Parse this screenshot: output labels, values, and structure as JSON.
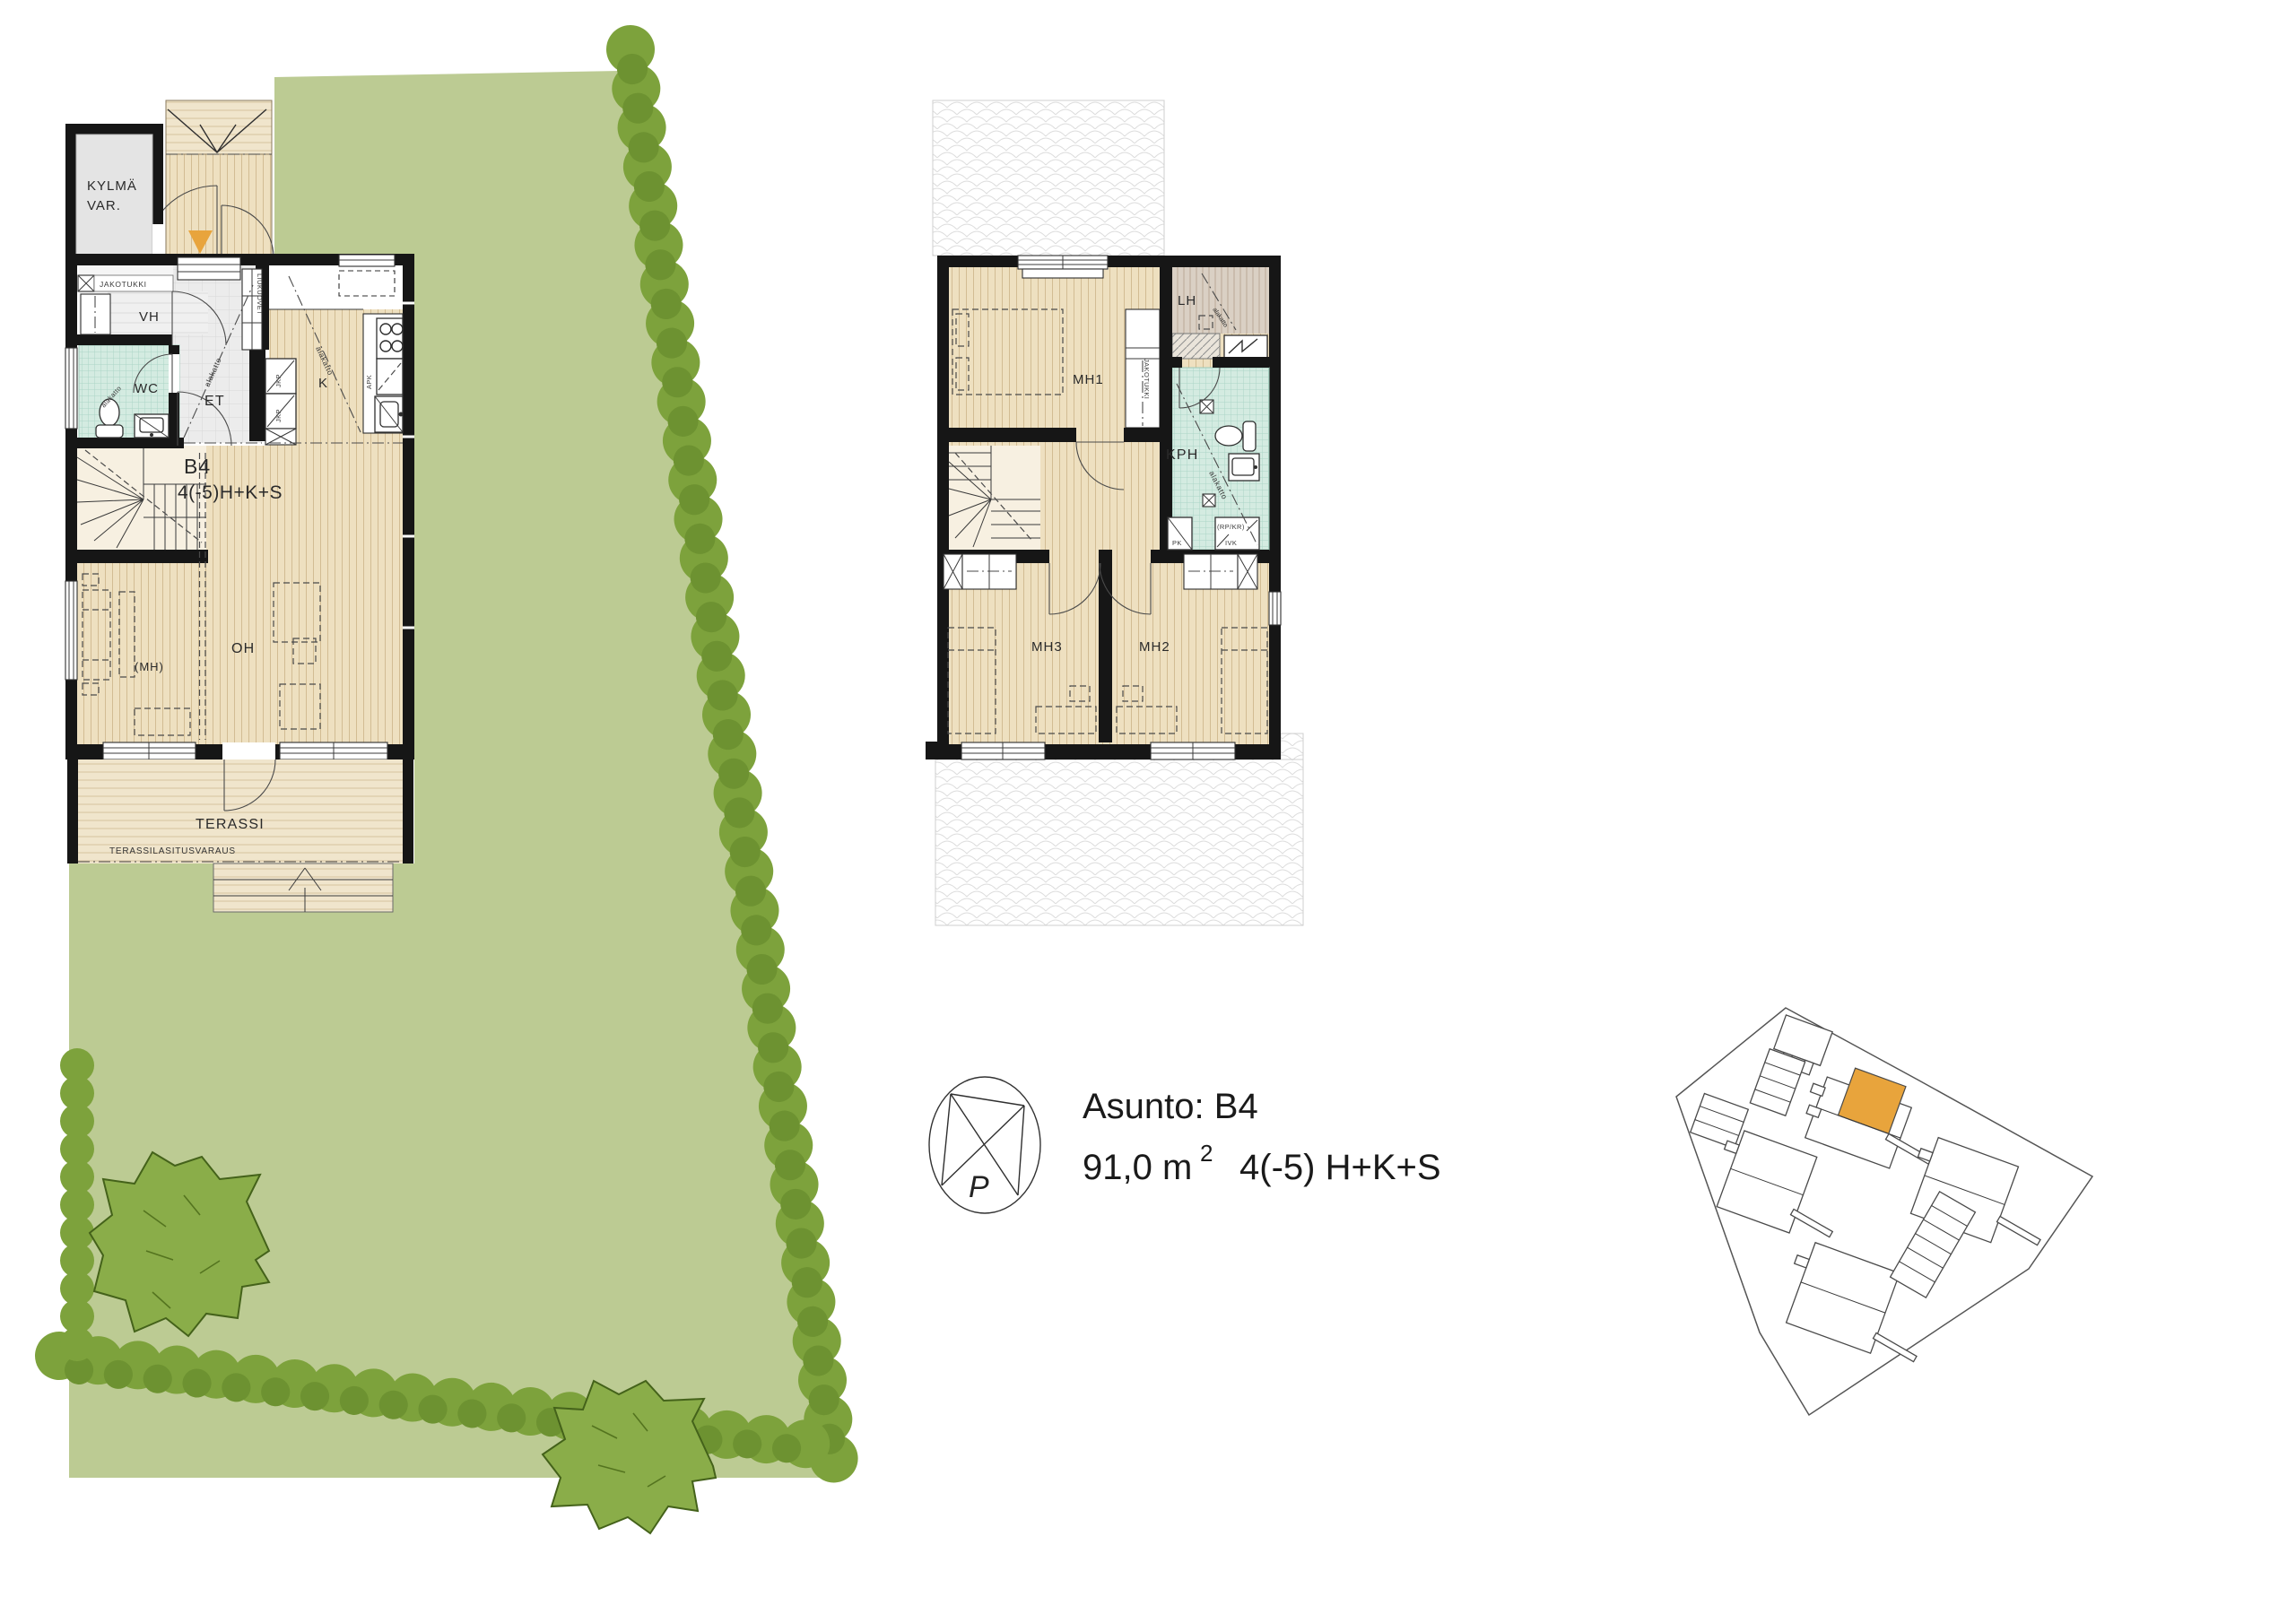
{
  "info": {
    "unit_label": "Asunto: B4",
    "area": "91,0 m",
    "area_superscript": "2",
    "room_spec": "4(-5) H+K+S",
    "compass_north": "P"
  },
  "ground_floor": {
    "unit_id": "B4",
    "unit_spec": "4(-5)H+K+S",
    "room_labels": {
      "cold_storage_1": "KYLMÄ",
      "cold_storage_2": "VAR.",
      "vestibule": "VH",
      "wc": "WC",
      "entry": "ET",
      "kitchen": "K",
      "living_room": "OH",
      "optional_bedroom": "(MH)",
      "terrace": "TERASSI"
    },
    "small_labels": {
      "manifold": "JAKOTUKKI",
      "sliding_doors": "LIUKUOVET",
      "suspended_ceiling": "alakatto",
      "fridge": "JKP",
      "dishwasher": "APK",
      "terrace_glazing": "TERASSILASITUSVARAUS"
    }
  },
  "upper_floor": {
    "room_labels": {
      "bedroom1": "MH1",
      "bedroom2": "MH2",
      "bedroom3": "MH3",
      "bathroom": "KPH",
      "sauna": "LH"
    },
    "small_labels": {
      "manifold": "JAKOTUKKI",
      "suspended_ceiling": "alakatto",
      "washing_machine": "PK",
      "rp_kr": "(RP/KR)",
      "ivk": "IVK"
    }
  },
  "colors": {
    "yard_green": "#bccb93",
    "hedge_green": "#7da23c",
    "hedge_dark": "#6d9231",
    "tree_green": "#8aad49",
    "accent_orange": "#e8a43c"
  }
}
